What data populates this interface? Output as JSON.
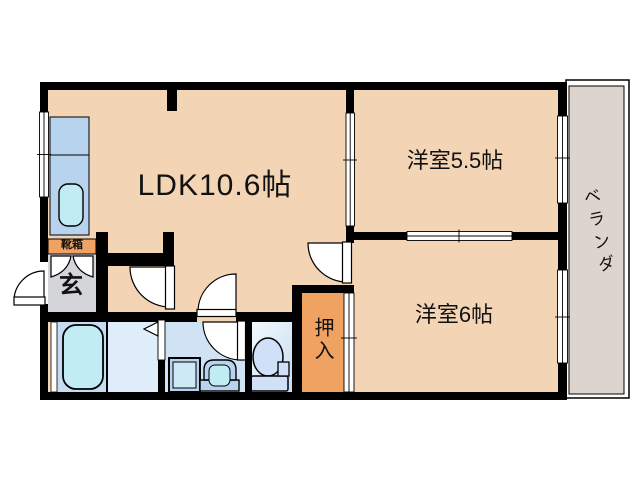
{
  "rooms": {
    "ldk": "LDK10.6帖",
    "western_room_5_5": "洋室5.5帖",
    "western_room_6": "洋室6帖",
    "veranda": "ベランダ",
    "closet": "押入",
    "entrance": "玄",
    "shoe_box": "靴箱"
  },
  "colors": {
    "wall": "#000000",
    "room_floor": "#f3d4b5",
    "veranda_floor": "#ddd5cd",
    "entrance_floor": "#d4d5d9",
    "closet_orange": "#f0a263",
    "bath_floor": "#c6dcf2",
    "dressing_floor": "#dfecf9",
    "washroom_floor": "#cfe3f5",
    "kitchen_counter": "#b7d3ee",
    "fixture_water": "#c2ecf4",
    "toilet_fixture": "#cfe0f8"
  }
}
